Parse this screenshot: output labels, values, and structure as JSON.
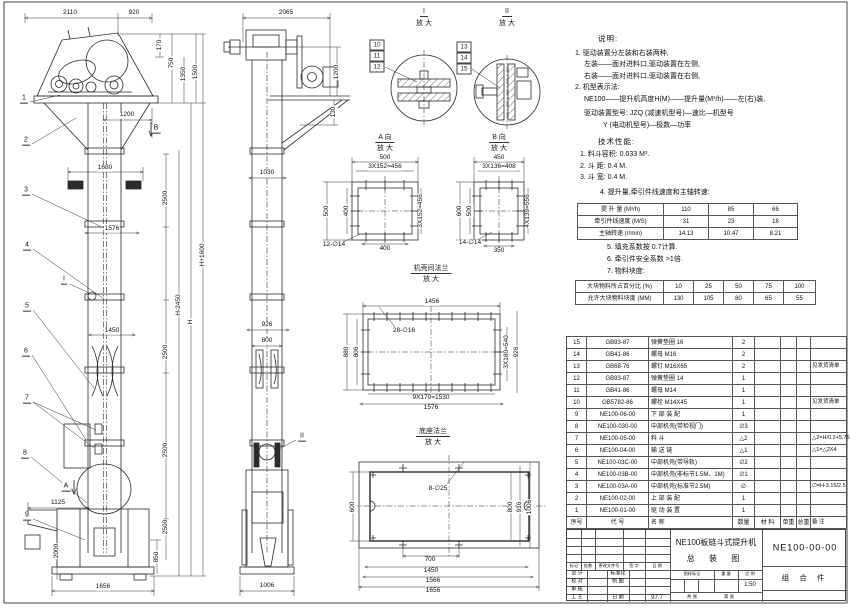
{
  "sheet": {
    "background": "#ffffff",
    "line_color": "#2b2b2b",
    "accent": "#111111"
  },
  "ui": {
    "mag": "放 大"
  },
  "balloons": {
    "b1": "1",
    "b2": "2",
    "b3": "3",
    "b4": "4",
    "b5": "5",
    "b6": "6",
    "b7": "7",
    "b8": "8",
    "b9": "9",
    "b10": "10",
    "b11": "11",
    "b12": "12",
    "b13": "13",
    "b14": "14",
    "b15": "15",
    "a": "A",
    "b": "B",
    "i": "I",
    "ii": "II"
  },
  "front": {
    "dims": {
      "d2110": "2110",
      "d920": "920",
      "d170": "170",
      "d750": "750",
      "d1350": "1350",
      "d1500": "1500",
      "d1200": "1200",
      "d1680": "1680",
      "d1576": "1576",
      "d2500": "2500",
      "d1450": "1450",
      "dh2450": "H-2450",
      "dh": "H",
      "dh1600": "H+1600",
      "d1125": "1125",
      "d2000": "2000",
      "d850": "850",
      "d1656": "1656"
    }
  },
  "side": {
    "dims": {
      "d2065": "2065",
      "d1200": "1200",
      "d130": "130",
      "d1030": "1030",
      "d926": "926",
      "d800": "800",
      "d1006": "1006"
    }
  },
  "detail_i": {
    "title": "I"
  },
  "detail_ii": {
    "title": "II"
  },
  "view_a": {
    "title": "A 向",
    "dims": {
      "d500": "500",
      "d456": "3X152=456",
      "d400": "400",
      "holes": "12-∅14"
    }
  },
  "view_b": {
    "title": "B 向",
    "dims": {
      "d450": "450",
      "d408": "3X136=408",
      "d600": "600",
      "d500": "500",
      "d556": "4X139=556",
      "d350": "350",
      "holes": "14-∅14"
    }
  },
  "flange": {
    "title": "机壳间法兰",
    "dims": {
      "d1456": "1456",
      "holes": "28-∅16",
      "d880": "880",
      "d806": "806",
      "d540": "3X180=540",
      "d926": "926",
      "d1530": "9X170=1530",
      "d1576": "1576"
    }
  },
  "base": {
    "title": "底座法兰",
    "dims": {
      "holes": "8-∅25",
      "d600": "600",
      "d800": "800",
      "d916": "916",
      "d1006": "1006",
      "d700": "700",
      "d1450": "1450",
      "d1566": "1566",
      "d1656": "1656"
    }
  },
  "notes": {
    "heading": "说明:",
    "n1": "1. 驱动装置分左装和右装两种,",
    "n1a": "左装——面对进料口,驱动装置在左侧,",
    "n1b": "右装——面对进料口,驱动装置在右侧,",
    "n2": "2. 机型表示法:",
    "n2a": "NE100——提升机高度H(M)——提升量(M³/h)——左(右)装,",
    "n2b": "驱动装置型号: JZQ (减速机型号)—速比—机型号",
    "n2c": "Y (电动机型号)—极数—功率"
  },
  "spec": {
    "heading": "技术性能:",
    "s1": "1. 料斗容积: 0.033 M³.",
    "s2": "2. 斗  距: 0.4 M.",
    "s3": "3. 斗  宽: 0.4 M.",
    "s4": "4. 提升量,牵引件线速度和主轴转速:",
    "s5": "5. 填充系数按 0.7计算.",
    "s6": "6. 牵引件安全系数 >1倍.",
    "s7": "7. 物料块度:"
  },
  "perf_table": {
    "rows": [
      [
        "提 升 量 (M³/h)",
        "110",
        "85",
        "66"
      ],
      [
        "牵引件线速度 (M/S)",
        "31",
        "23",
        "18"
      ],
      [
        "主轴转速 (r/min)",
        "14.13",
        "10.47",
        "8.21"
      ]
    ]
  },
  "size_table": {
    "rows": [
      [
        "大块物料所占百分比 (%)",
        "10",
        "25",
        "50",
        "75",
        "100"
      ],
      [
        "允许大块物料块度 (MM)",
        "130",
        "105",
        "80",
        "65",
        "55"
      ]
    ]
  },
  "bom": {
    "rows": [
      [
        "15",
        "GB93-87",
        "弹簧垫圈  16",
        "2",
        "",
        "",
        "",
        ""
      ],
      [
        "14",
        "GB41-86",
        "螺母  M16",
        "2",
        "",
        "",
        "",
        ""
      ],
      [
        "13",
        "GB68-76",
        "螺钉  M16X65",
        "2",
        "",
        "",
        "",
        "见发货清单"
      ],
      [
        "12",
        "GB93-87",
        "弹簧垫圈  14",
        "1",
        "",
        "",
        "",
        ""
      ],
      [
        "11",
        "GB41-86",
        "螺母  M14",
        "1",
        "",
        "",
        "",
        ""
      ],
      [
        "10",
        "GB5782-86",
        "螺栓  M14X45",
        "1",
        "",
        "",
        "",
        "见发货清单"
      ],
      [
        "9",
        "NE100-06-00",
        "下 部 装 配",
        "1",
        "",
        "",
        "",
        ""
      ],
      [
        "8",
        "NE100-030-00",
        "中部机壳(带检视门)",
        "∅3",
        "",
        "",
        "",
        ""
      ],
      [
        "7",
        "NE100-05-00",
        "料 斗",
        "△2",
        "",
        "",
        "",
        "△2=H/0.2+5.75"
      ],
      [
        "6",
        "NE100-04-00",
        "输 送 链",
        "△1",
        "",
        "",
        "",
        "△1=△2X4"
      ],
      [
        "5",
        "NE100-03C-00",
        "中部机壳(带导轨)",
        "∅2",
        "",
        "",
        "",
        ""
      ],
      [
        "4",
        "NE100-03B-00",
        "中部机壳(非标节1.5M、1M)",
        "∅1",
        "",
        "",
        "",
        ""
      ],
      [
        "3",
        "NE100-03A-00",
        "中部机壳(标准节2.5M)",
        "∅",
        "",
        "",
        "",
        "∅=H-3.15/2.5"
      ],
      [
        "2",
        "NE100-02-00",
        "上 部 装 配",
        "1",
        "",
        "",
        "",
        ""
      ],
      [
        "1",
        "NE100-01-00",
        "驱 动 装 置",
        "1",
        "",
        "",
        "",
        ""
      ]
    ],
    "header_rows": [
      [
        "序号",
        "代  号",
        "名    称",
        "数量",
        "材  料",
        "单重",
        "总重",
        "备  注"
      ]
    ]
  },
  "titleblock": {
    "title_line1": "NE100板链斗式提升机",
    "title_line2": "总 装 图",
    "drawing_no": "NE100-00-00",
    "part_type": "组 合 件",
    "rev": {
      "mark": "标记",
      "count": "处数",
      "doc": "更改文件号",
      "sign": "签 字",
      "date": "日 期"
    },
    "roles": {
      "design": "设 计",
      "check": "校 对",
      "audit": "审 核",
      "process": "工 艺",
      "standard": "标准化",
      "draft": "制 图",
      "date": "日 期",
      "date_value": "97.7"
    },
    "stamp": {
      "mark": "图样标记",
      "weight": "重 量",
      "scale": "比 例",
      "scale_value": "1:50",
      "sheets": "共  张",
      "page": "第  张"
    }
  }
}
